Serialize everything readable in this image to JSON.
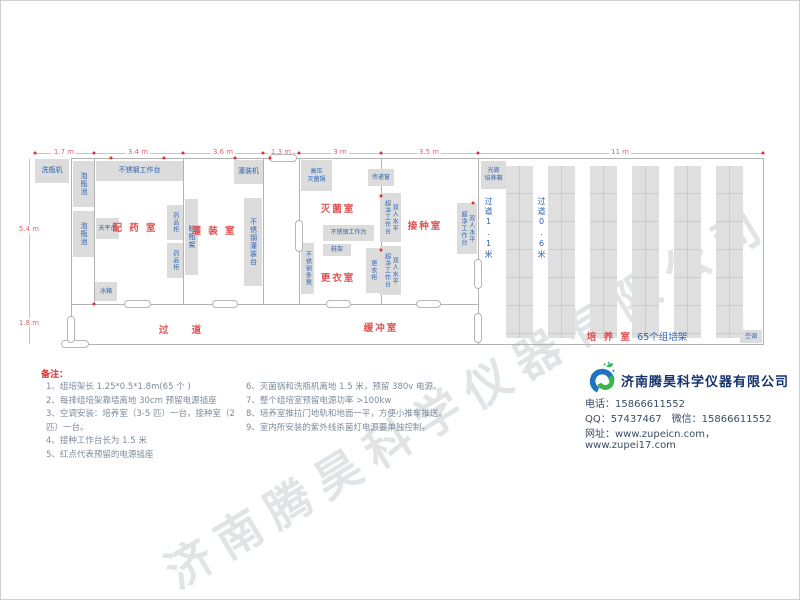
{
  "watermark": {
    "text": "济南腾昊科学仪器有限公司"
  },
  "plan": {
    "walls": [
      [
        70,
        157,
        692,
        1
      ],
      [
        70,
        303,
        407,
        1
      ],
      [
        70,
        343,
        692,
        1
      ],
      [
        70,
        157,
        1,
        186
      ],
      [
        93,
        157,
        1,
        146
      ],
      [
        182,
        157,
        1,
        146
      ],
      [
        262,
        157,
        1,
        146
      ],
      [
        298,
        157,
        1,
        146
      ],
      [
        380,
        157,
        1,
        146
      ],
      [
        477,
        157,
        1,
        186
      ],
      [
        762,
        157,
        1,
        187
      ]
    ],
    "dim_lines": [
      [
        34,
        152,
        728,
        1
      ],
      [
        28,
        158,
        1,
        185
      ]
    ],
    "dim_labels": [
      {
        "text": "1.7 m",
        "x": 63,
        "y": 151
      },
      {
        "text": "3.4 m",
        "x": 137,
        "y": 151
      },
      {
        "text": "3.6 m",
        "x": 222,
        "y": 151
      },
      {
        "text": "1.3 m",
        "x": 280,
        "y": 151
      },
      {
        "text": "3 m",
        "x": 339,
        "y": 151
      },
      {
        "text": "3.5 m",
        "x": 428,
        "y": 151
      },
      {
        "text": "11 m",
        "x": 619,
        "y": 151
      },
      {
        "text": "5.4 m",
        "x": 28,
        "y": 228
      },
      {
        "text": "1.8 m",
        "x": 28,
        "y": 322
      }
    ],
    "rooms": [
      {
        "label": "配 药 室",
        "x": 134,
        "y": 226
      },
      {
        "label": "灌 装 室",
        "x": 213,
        "y": 229
      },
      {
        "label": "灭菌室",
        "x": 337,
        "y": 207
      },
      {
        "label": "接种室",
        "x": 424,
        "y": 224
      },
      {
        "label": "更衣室",
        "x": 337,
        "y": 276
      },
      {
        "label": "缓冲室",
        "x": 380,
        "y": 326
      },
      {
        "label": "过    道",
        "x": 180,
        "y": 328
      }
    ],
    "furniture": [
      {
        "label": "洗瓶机",
        "x": 34,
        "y": 158,
        "w": 34,
        "h": 24,
        "o": "h"
      },
      {
        "label": "泡瓶池",
        "x": 72,
        "y": 160,
        "w": 21,
        "h": 46,
        "o": "v"
      },
      {
        "label": "泡瓶池",
        "x": 72,
        "y": 210,
        "w": 21,
        "h": 46,
        "o": "v"
      },
      {
        "label": "不锈钢工作台",
        "x": 95,
        "y": 160,
        "w": 87,
        "h": 20,
        "o": "h"
      },
      {
        "label": "天平台",
        "x": 95,
        "y": 217,
        "w": 23,
        "h": 21,
        "o": "h",
        "fs": 6
      },
      {
        "label": "冰箱",
        "x": 94,
        "y": 281,
        "w": 22,
        "h": 19,
        "o": "h",
        "fs": 6
      },
      {
        "label": "药品柜",
        "x": 166,
        "y": 204,
        "w": 16,
        "h": 35,
        "o": "v",
        "fs": 6
      },
      {
        "label": "药品柜",
        "x": 166,
        "y": 242,
        "w": 16,
        "h": 35,
        "o": "v",
        "fs": 6
      },
      {
        "label": "晾瓶架",
        "x": 184,
        "y": 198,
        "w": 13,
        "h": 76,
        "o": "v"
      },
      {
        "label": "不锈钢灌装台",
        "x": 243,
        "y": 197,
        "w": 18,
        "h": 88,
        "o": "v"
      },
      {
        "label": "灌装机",
        "x": 233,
        "y": 159,
        "w": 29,
        "h": 24,
        "o": "h"
      },
      {
        "label": "高压\n灭菌锅",
        "x": 300,
        "y": 159,
        "w": 31,
        "h": 31,
        "o": "h",
        "fs": 6
      },
      {
        "label": "传递窗",
        "x": 367,
        "y": 168,
        "w": 26,
        "h": 17,
        "o": "h",
        "fs": 6
      },
      {
        "label": "不锈钢工作台",
        "x": 322,
        "y": 224,
        "w": 51,
        "h": 16,
        "o": "h",
        "fs": 6
      },
      {
        "label": "鞋架",
        "x": 322,
        "y": 243,
        "w": 28,
        "h": 12,
        "o": "h",
        "fs": 6
      },
      {
        "label": "不锈钢条凳",
        "x": 300,
        "y": 242,
        "w": 13,
        "h": 51,
        "o": "v",
        "fs": 6
      },
      {
        "label": "更衣柜",
        "x": 365,
        "y": 247,
        "w": 14,
        "h": 45,
        "o": "v",
        "fs": 6
      },
      {
        "label": "双人水平\n超净工作台",
        "x": 379,
        "y": 192,
        "w": 21,
        "h": 49,
        "o": "v",
        "fs": 6
      },
      {
        "label": "双人水平\n超净工作台",
        "x": 379,
        "y": 245,
        "w": 21,
        "h": 49,
        "o": "v",
        "fs": 6
      },
      {
        "label": "双人水平\n超净工作台",
        "x": 456,
        "y": 202,
        "w": 20,
        "h": 51,
        "o": "v",
        "fs": 6
      },
      {
        "label": "光周\n培养箱",
        "x": 480,
        "y": 160,
        "w": 25,
        "h": 28,
        "o": "h",
        "fs": 6
      },
      {
        "label": "空调",
        "x": 739,
        "y": 329,
        "w": 22,
        "h": 13,
        "o": "h",
        "fs": 6
      }
    ],
    "doors": [
      [
        268,
        153,
        28,
        8
      ],
      [
        123,
        299,
        27,
        8
      ],
      [
        211,
        299,
        26,
        8
      ],
      [
        325,
        299,
        25,
        8
      ],
      [
        415,
        299,
        25,
        8
      ],
      [
        60,
        339,
        28,
        8
      ],
      [
        66,
        315,
        8,
        27
      ],
      [
        294,
        219,
        8,
        32
      ],
      [
        473,
        258,
        8,
        30
      ],
      [
        473,
        312,
        8,
        30
      ]
    ],
    "sockets": [
      [
        34,
        152
      ],
      [
        93,
        152
      ],
      [
        110,
        157
      ],
      [
        163,
        157
      ],
      [
        182,
        152
      ],
      [
        234,
        157
      ],
      [
        262,
        152
      ],
      [
        298,
        152
      ],
      [
        380,
        152
      ],
      [
        477,
        152
      ],
      [
        762,
        152
      ],
      [
        380,
        195
      ],
      [
        380,
        249
      ],
      [
        472,
        202
      ],
      [
        93,
        303
      ],
      [
        269,
        157
      ]
    ],
    "shelves": {
      "x0": 505,
      "pitch": 42,
      "count": 6,
      "w": 27,
      "y": 165,
      "h": 172
    },
    "aisles": [
      {
        "text": "过道1.1米",
        "x": 483,
        "y": 196
      },
      {
        "text": "过道0.6米",
        "x": 536,
        "y": 196
      }
    ],
    "culture_label": {
      "red": "培 养 室 ",
      "blue": "65个组培架",
      "x": 636,
      "y": 335
    }
  },
  "notes": {
    "title": "备注：",
    "col1": [
      "1、组培架长 1.25*0.5*1.8m(65 个 )",
      "2、每排组培架靠墙离地 30cm 预留电源插座",
      "3、空调安装：培养室（3-5 匹）一台，接种室（2 匹）一台。",
      "4、接种工作台长为 1.5 米",
      "5、红点代表预留的电源插座"
    ],
    "col2": [
      "6、灭菌锅和洗瓶机离地 1.5 米，预留 380v 电源。",
      "7、整个组培室预留电源功率 >100kw",
      "8、培养室推拉门地轨和地面一平，方便小推车推送。",
      "9、室内所安装的紫外线杀菌灯电源要单独控制。"
    ]
  },
  "company": {
    "name": "济南腾昊科学仪器有限公司",
    "phone": "电话：15866611552",
    "qq": "QQ：57437467　微信：15866611552",
    "web": "网址：www.zupeicn.com，www.zupei17.com"
  },
  "colors": {
    "accent_red": "#e05050",
    "accent_blue": "#2e62b1",
    "dim_red": "#e06666",
    "wall_gray": "#b3b3b3",
    "furniture_gray": "#dcdcdc"
  }
}
